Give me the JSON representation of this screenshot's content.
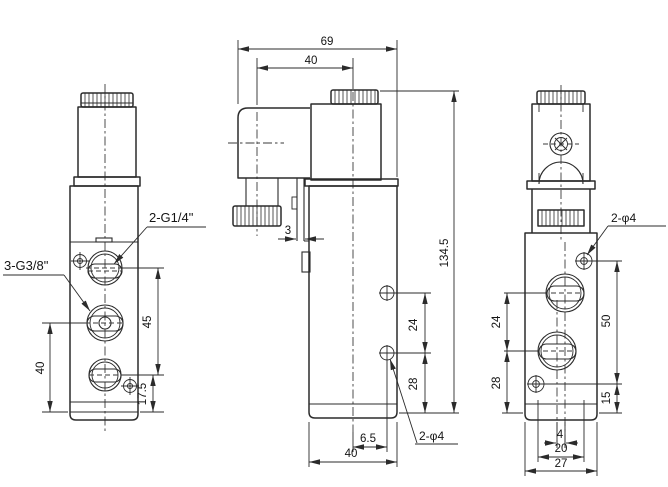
{
  "drawing": {
    "type": "engineering-drawing",
    "subject": "solenoid-valve three-view dimensional drawing",
    "colors": {
      "line": "#2b2b2b",
      "text": "#141414",
      "background": "#ffffff"
    },
    "left_view": {
      "port_labels": {
        "top": "2-G1/4\"",
        "middle": "3-G3/8\""
      },
      "dims": {
        "port_span": "45",
        "mid_port_to_base": "40",
        "bottom_port_to_base": "17.5"
      }
    },
    "middle_view": {
      "dims": {
        "overall_length": "69",
        "gland_to_coil": "40",
        "overall_height": "134.5",
        "plate_thickness": "3",
        "hole_spacing": "24",
        "hole_to_base": "28",
        "hole_offset": "6.5",
        "body_width": "40"
      },
      "hole_label": "2-φ4"
    },
    "right_view": {
      "dims": {
        "port_spacing": "24",
        "port_to_base": "28",
        "screw_span": "50",
        "screw_to_base": "15",
        "port_offset": "4",
        "knurl_width": "20",
        "body_width": "27"
      },
      "hole_label": "2-φ4"
    }
  }
}
